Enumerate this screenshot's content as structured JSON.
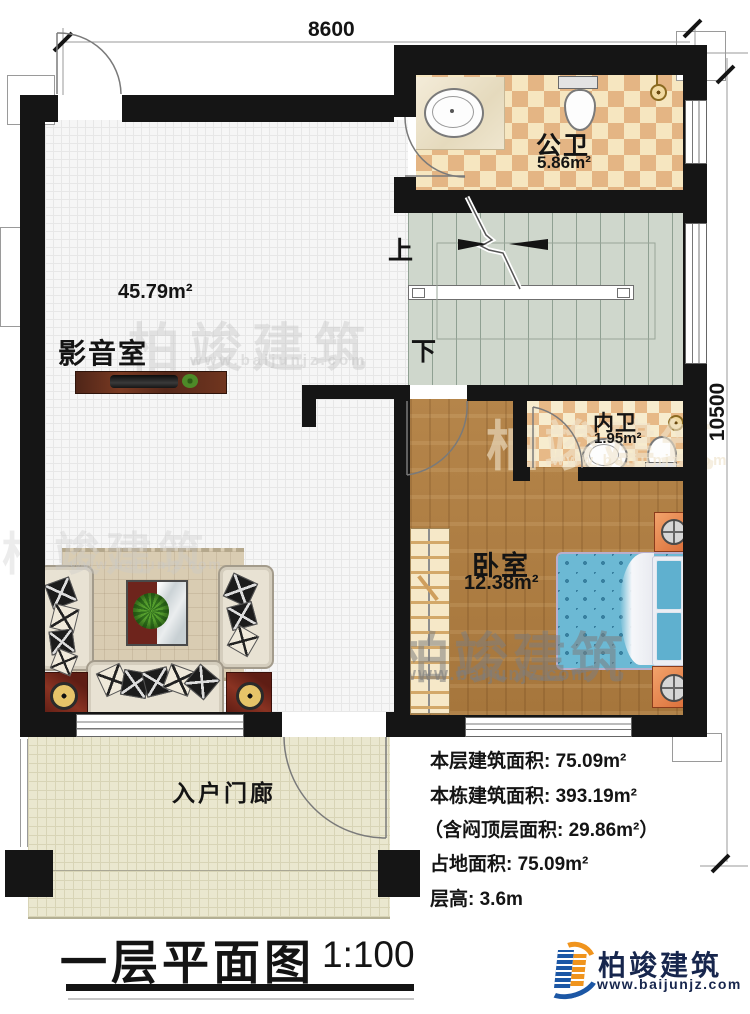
{
  "meta": {
    "sheet_title": "一层平面图",
    "scale": "1:100"
  },
  "dims": {
    "top": "8600",
    "right": "10500"
  },
  "rooms": {
    "media": {
      "name": "影音室",
      "area": "45.79m²"
    },
    "public_bath": {
      "name": "公卫",
      "area": "5.86m²"
    },
    "inner_bath": {
      "name": "内卫",
      "area": "1.95m²"
    },
    "bedroom": {
      "name": "卧室",
      "area": "12.38m²"
    },
    "porch": {
      "name": "入户门廊"
    },
    "stairs": {
      "up": "上",
      "down": "下"
    }
  },
  "info": {
    "lines": [
      "本层建筑面积: 75.09m²",
      "本栋建筑面积: 393.19m²",
      "（含闷顶层面积: 29.86m²）",
      "占地面积: 75.09m²",
      "层高: 3.6m"
    ]
  },
  "branding": {
    "company": "柏竣建筑",
    "website": "www.baijunjz.com"
  },
  "watermark": {
    "text": "柏竣建筑",
    "url": "www.baijunjz.com"
  }
}
